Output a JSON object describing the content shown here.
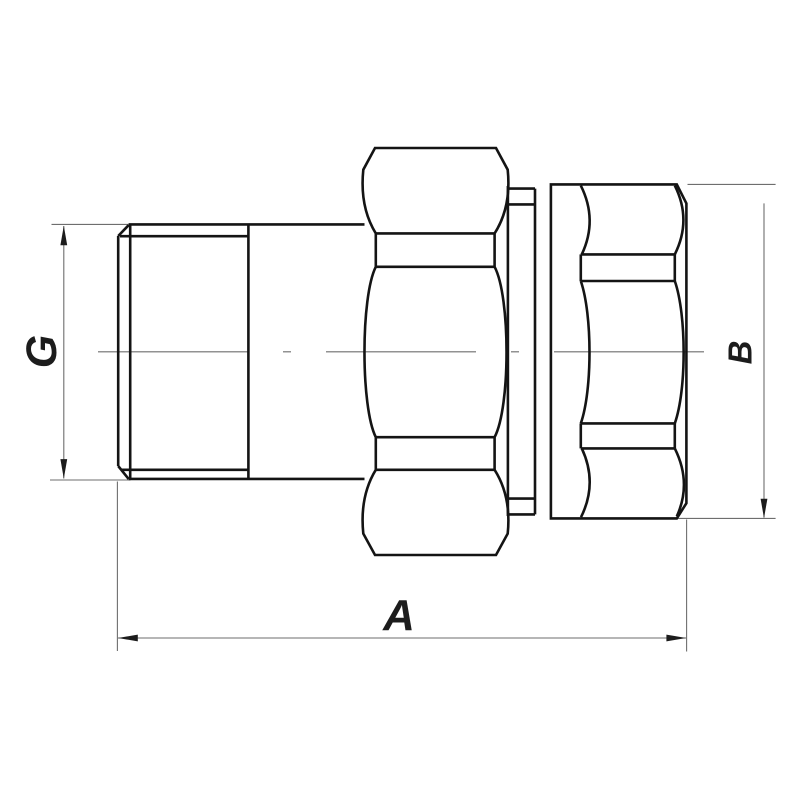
{
  "drawing": {
    "title": "Threaded pipe union fitting - orthographic side view",
    "labels": {
      "g": "G",
      "a": "A",
      "b": "B"
    },
    "colors": {
      "object_line": "#141414",
      "thin_line": "#6e6e6e",
      "text": "#1c1c1c",
      "background": "#ffffff"
    }
  }
}
